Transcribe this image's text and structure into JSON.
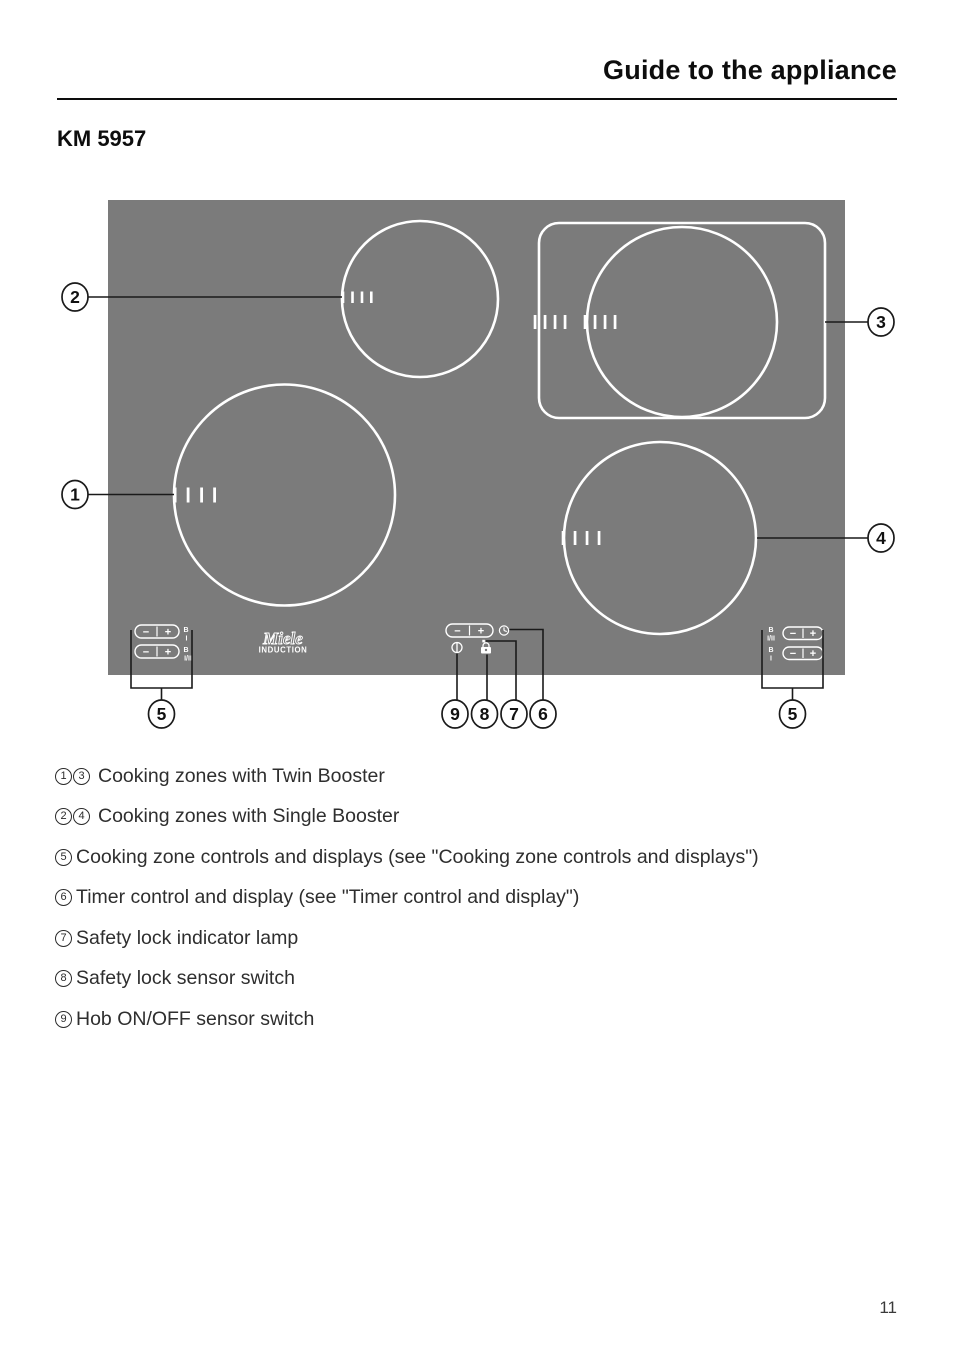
{
  "header": {
    "title": "Guide to the appliance",
    "model": "KM 5957"
  },
  "diagram": {
    "callouts": {
      "zone1": "1",
      "zone2": "2",
      "zone3": "3",
      "zone4": "4",
      "controls_left": "5",
      "controls_right": "5",
      "timer": "6",
      "lock_lamp": "7",
      "lock_switch": "8",
      "power": "9"
    },
    "controls": {
      "minus": "−",
      "plus": "+",
      "booster": "B",
      "level_i": "I",
      "level_i_ii": "I/II"
    },
    "brand": {
      "name": "Miele",
      "sub": "INDUCTION"
    }
  },
  "colors": {
    "hob_gray": "#7b7b7b",
    "line_black": "#1a1a1a",
    "white": "#ffffff"
  },
  "legend": {
    "items": [
      {
        "refs": [
          "1",
          "3"
        ],
        "text": "Cooking zones with Twin Booster"
      },
      {
        "refs": [
          "2",
          "4"
        ],
        "text": "Cooking zones with Single Booster"
      },
      {
        "refs": [
          "5"
        ],
        "text": "Cooking zone controls and displays (see \"Cooking zone controls and displays\")"
      },
      {
        "refs": [
          "6"
        ],
        "text": "Timer control and display (see \"Timer control and display\")"
      },
      {
        "refs": [
          "7"
        ],
        "text": "Safety lock indicator lamp"
      },
      {
        "refs": [
          "8"
        ],
        "text": "Safety lock sensor switch"
      },
      {
        "refs": [
          "9"
        ],
        "text": "Hob ON/OFF sensor switch"
      }
    ]
  },
  "page_number": "11"
}
